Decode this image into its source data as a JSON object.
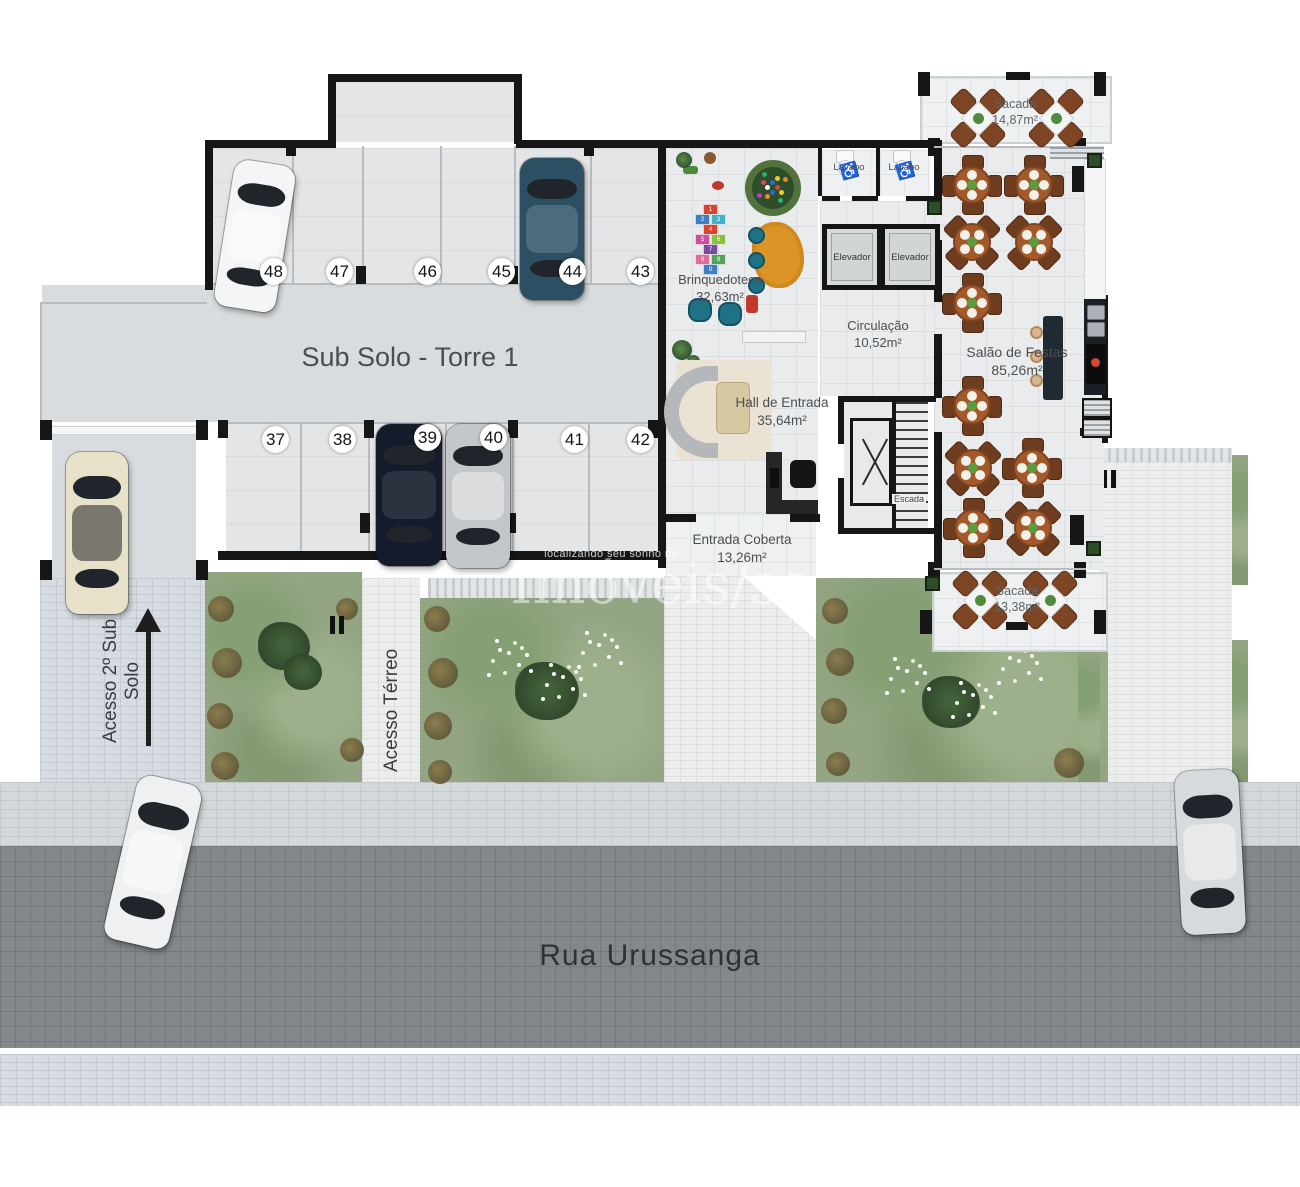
{
  "plan": {
    "garage": {
      "label": "Sub Solo - Torre 1",
      "parking_top": [
        "48",
        "47",
        "46",
        "45",
        "44",
        "43"
      ],
      "parking_bottom": [
        "37",
        "38",
        "39",
        "40",
        "41",
        "42"
      ]
    },
    "access": {
      "sub_solo": "Acesso 2º Sub Solo",
      "terreo": "Acesso Térreo"
    },
    "street": {
      "name": "Rua Urussanga"
    },
    "rooms": {
      "brinquedoteca": {
        "name": "Brinquedoteca",
        "area": "32,63m²"
      },
      "lavabo_1": {
        "name": "Lavabo"
      },
      "lavabo_2": {
        "name": "Lavabo"
      },
      "elevador_1": {
        "name": "Elevador"
      },
      "elevador_2": {
        "name": "Elevador"
      },
      "circulacao": {
        "name": "Circulação",
        "area": "10,52m²"
      },
      "hall_entrada": {
        "name": "Hall de Entrada",
        "area": "35,64m²"
      },
      "entrada_coberta": {
        "name": "Entrada Coberta",
        "area": "13,26m²"
      },
      "escada": {
        "name": "Escada"
      },
      "salao_festas": {
        "name": "Salão de Festas",
        "area": "85,26m²"
      },
      "sacada_norte": {
        "name": "Sacada",
        "area": "14,87m²"
      },
      "sacada_sul": {
        "name": "Sacada",
        "area": "13,38m²"
      }
    },
    "watermark": {
      "tagline": "localizando seu sonho na cidade",
      "brand": "Imóveis/sc"
    },
    "hopscotch": {
      "numbers": [
        "1",
        "2",
        "3",
        "4",
        "5",
        "6",
        "7",
        "8",
        "9",
        "0"
      ],
      "colors": [
        "#d8432f",
        "#3f7fc1",
        "#45b1c6",
        "#d8432f",
        "#c94f9b",
        "#8bbf3f",
        "#7a4a9e",
        "#de6a9a",
        "#55a05a",
        "#3f7fc1"
      ]
    },
    "palette": {
      "wall": "#161616",
      "floor_tile": "#e9ebec",
      "garden": "#93a583",
      "street": "#84888b",
      "table_wood": "#a4592b",
      "teal": "#1f7285",
      "accent_yellow": "#c9cf35"
    }
  }
}
